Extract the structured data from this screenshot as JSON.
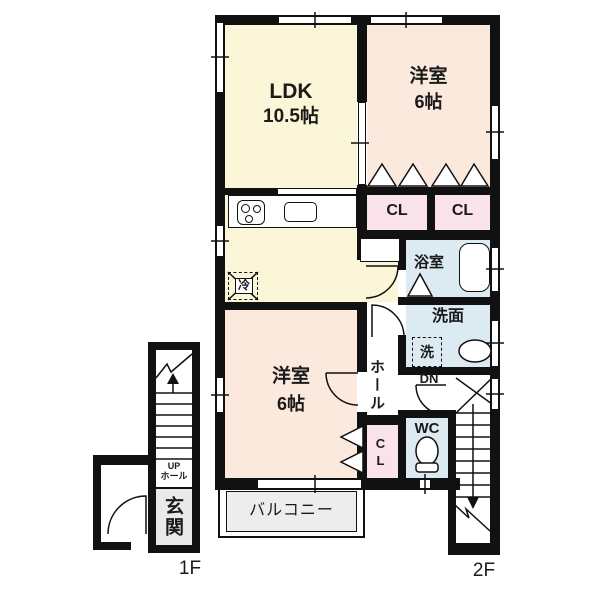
{
  "colors": {
    "wall": "#111111",
    "ldk_fill": "#faf6d7",
    "bedroom_fill": "#fbe9dd",
    "closet_fill": "#fae2ea",
    "wet_area_fill": "#dcebf2",
    "balcony_fill": "#ededed",
    "entrance_fill": "#e9e9e9",
    "line": "#111111"
  },
  "floor_labels": {
    "first_floor": "1F",
    "second_floor": "2F"
  },
  "rooms": {
    "ldk": {
      "name": "LDK",
      "size": "10.5帖"
    },
    "bedroom_upper": {
      "name": "洋室",
      "size": "6帖"
    },
    "bedroom_lower": {
      "name": "洋室",
      "size": "6帖"
    },
    "closet_upper_left": {
      "label": "CL"
    },
    "closet_upper_right": {
      "label": "CL"
    },
    "closet_lower": {
      "label": "CL"
    },
    "bathroom": {
      "label": "浴室"
    },
    "washroom": {
      "label": "洗面"
    },
    "hall": {
      "label": "ホール"
    },
    "wc": {
      "label": "WC"
    },
    "balcony": {
      "label": "バルコニー"
    },
    "entrance": {
      "label": "玄関"
    }
  },
  "fixtures": {
    "washing_machine": {
      "label": "洗"
    },
    "refrigerator": {
      "label": "冷"
    }
  },
  "stairs": {
    "down_label": "DN",
    "up_label": "UP",
    "up_hall_label": "ホール"
  }
}
